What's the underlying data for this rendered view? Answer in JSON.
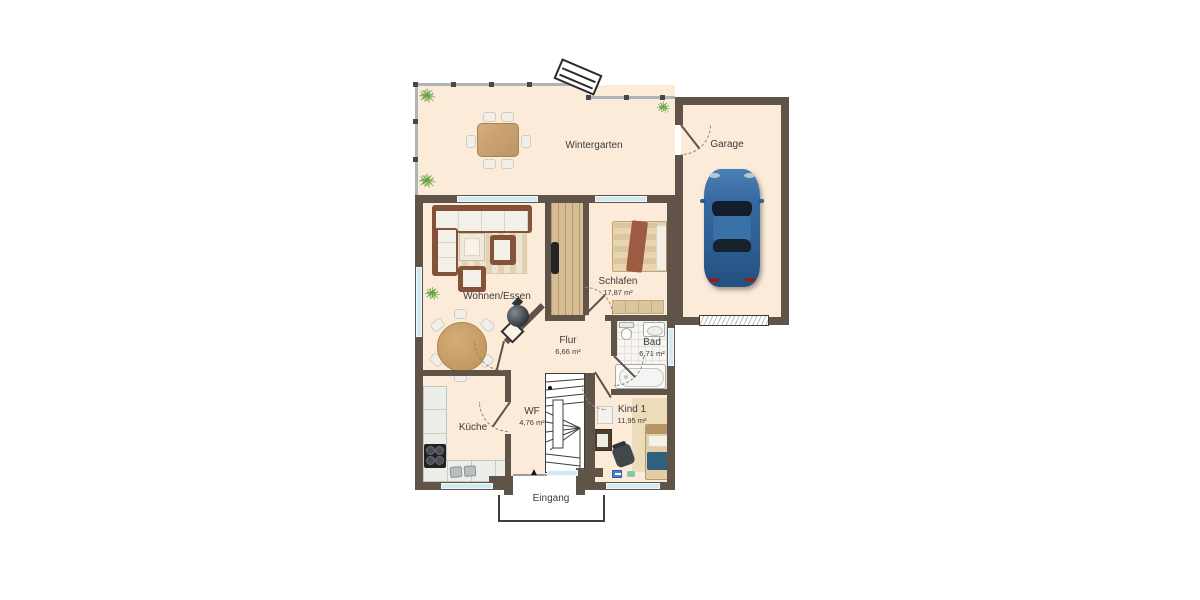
{
  "colors": {
    "wall": "#5f5447",
    "floor": "#fcebd9",
    "window": "#cfeaf2",
    "glass": "#aeb4b8",
    "label": "#3b3b3b",
    "wood": "#d6bd93",
    "car_body": "#35689e",
    "tile": "#f7f6f2"
  },
  "rooms": [
    {
      "name": "Wintergarten",
      "area": ""
    },
    {
      "name": "Garage",
      "area": ""
    },
    {
      "name": "Wohnen/Essen",
      "area": ""
    },
    {
      "name": "Schlafen",
      "area": "17,87 m²"
    },
    {
      "name": "Bad",
      "area": "6,71 m²"
    },
    {
      "name": "Flur",
      "area": "6,66 m²"
    },
    {
      "name": "WF",
      "area": "4,76 m²"
    },
    {
      "name": "Küche",
      "area": ""
    },
    {
      "name": "Kind 1",
      "area": "11,95 m²"
    },
    {
      "name": "Eingang",
      "area": ""
    }
  ],
  "icons": {
    "plant": "✳",
    "entrance_arrow": "▲"
  }
}
